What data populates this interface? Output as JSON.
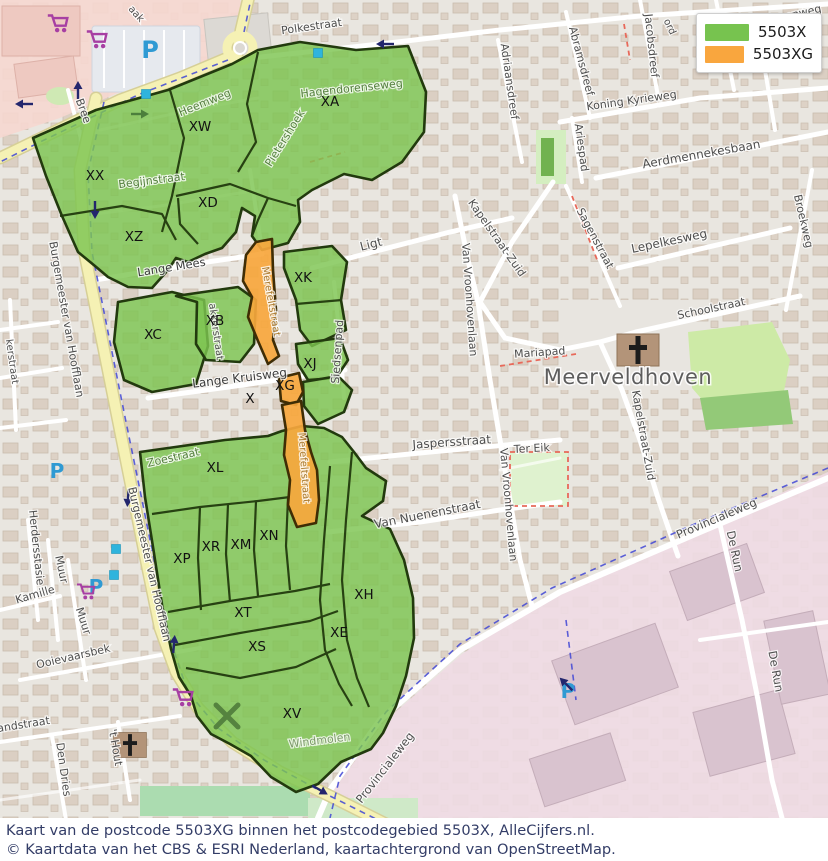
{
  "legend": {
    "items": [
      {
        "label": "5503X",
        "color": "#77c34f"
      },
      {
        "label": "5503XG",
        "color": "#f9a63e"
      }
    ]
  },
  "caption": {
    "line1": "Kaart van de postcode 5503XG binnen het postcodegebied 5503X, AlleCijfers.nl.",
    "line2": "© Kaartdata van het CBS & ESRI Nederland, kaartachtergrond van OpenStreetMap."
  },
  "map": {
    "region_fill": {
      "green": "#7cc551",
      "orange": "#f7a73d"
    },
    "place_label": {
      "text": "Meerveldhoven",
      "x": 628,
      "y": 384
    },
    "region_labels": [
      {
        "code": "XA",
        "x": 330,
        "y": 106
      },
      {
        "code": "XW",
        "x": 200,
        "y": 131
      },
      {
        "code": "XX",
        "x": 95,
        "y": 180
      },
      {
        "code": "XD",
        "x": 208,
        "y": 207
      },
      {
        "code": "XZ",
        "x": 134,
        "y": 241
      },
      {
        "code": "XK",
        "x": 303,
        "y": 282
      },
      {
        "code": "XB",
        "x": 215,
        "y": 325
      },
      {
        "code": "XC",
        "x": 153,
        "y": 339
      },
      {
        "code": "XJ",
        "x": 310,
        "y": 368
      },
      {
        "code": "X",
        "x": 250,
        "y": 403
      },
      {
        "code": "XG",
        "x": 285,
        "y": 390
      },
      {
        "code": "XL",
        "x": 215,
        "y": 472
      },
      {
        "code": "XP",
        "x": 182,
        "y": 563
      },
      {
        "code": "XR",
        "x": 211,
        "y": 551
      },
      {
        "code": "XM",
        "x": 241,
        "y": 549
      },
      {
        "code": "XN",
        "x": 269,
        "y": 540
      },
      {
        "code": "XT",
        "x": 243,
        "y": 617
      },
      {
        "code": "XS",
        "x": 257,
        "y": 651
      },
      {
        "code": "XE",
        "x": 339,
        "y": 637
      },
      {
        "code": "XH",
        "x": 364,
        "y": 599
      },
      {
        "code": "XV",
        "x": 292,
        "y": 718
      }
    ],
    "street_labels": [
      {
        "t": "Polkestraat",
        "x": 312,
        "y": 30,
        "r": -8,
        "s": 11,
        "c": "#4e4e4e"
      },
      {
        "t": "Hagendorenweg",
        "x": 778,
        "y": 22,
        "r": -13,
        "s": 11,
        "c": "#4e4e4e"
      },
      {
        "t": "ord",
        "x": 667,
        "y": 28,
        "r": 65,
        "s": 10,
        "c": "#4e4e4e"
      },
      {
        "t": "aak",
        "x": 134,
        "y": 16,
        "r": 48,
        "s": 10,
        "c": "#4e4e4e"
      },
      {
        "t": "Adriaansdreef",
        "x": 506,
        "y": 82,
        "r": 82,
        "s": 11,
        "c": "#4e4e4e"
      },
      {
        "t": "Abramsdreef",
        "x": 578,
        "y": 62,
        "r": 75,
        "s": 11,
        "c": "#4e4e4e"
      },
      {
        "t": "Jacobsdreef",
        "x": 648,
        "y": 46,
        "r": 84,
        "s": 11,
        "c": "#4e4e4e"
      },
      {
        "t": "Koning Kyrieweg",
        "x": 632,
        "y": 104,
        "r": -8,
        "s": 11,
        "c": "#4e4e4e"
      },
      {
        "t": "Ariespad",
        "x": 578,
        "y": 148,
        "r": 82,
        "s": 11,
        "c": "#4e4e4e"
      },
      {
        "t": "Aerdmennekesbaan",
        "x": 702,
        "y": 158,
        "r": -10,
        "s": 12,
        "c": "#4e4e4e"
      },
      {
        "t": "Sagenstraat",
        "x": 592,
        "y": 240,
        "r": 62,
        "s": 11,
        "c": "#4e4e4e"
      },
      {
        "t": "Lepelkesweg",
        "x": 670,
        "y": 245,
        "r": -12,
        "s": 12,
        "c": "#4e4e4e"
      },
      {
        "t": "Broekweg",
        "x": 800,
        "y": 222,
        "r": 77,
        "s": 11,
        "c": "#4e4e4e"
      },
      {
        "t": "Schoolstraat",
        "x": 712,
        "y": 312,
        "r": -12,
        "s": 11,
        "c": "#4e4e4e"
      },
      {
        "t": "Kapelstraat-Zuid",
        "x": 494,
        "y": 240,
        "r": 55,
        "s": 11,
        "c": "#4e4e4e"
      },
      {
        "t": "Kapelstraat-Zuid",
        "x": 640,
        "y": 436,
        "r": 80,
        "s": 11,
        "c": "#4e4e4e"
      },
      {
        "t": "Van Vroonhovenlaan",
        "x": 466,
        "y": 300,
        "r": 86,
        "s": 11,
        "c": "#4e4e4e"
      },
      {
        "t": "Van Vroonhovenlaan",
        "x": 505,
        "y": 505,
        "r": 85,
        "s": 11,
        "c": "#4e4e4e"
      },
      {
        "t": "Mariapad",
        "x": 540,
        "y": 356,
        "r": -4,
        "s": 11,
        "c": "#4e4e4e"
      },
      {
        "t": "Ter Eik",
        "x": 532,
        "y": 452,
        "r": -3,
        "s": 11,
        "c": "#4e4e4e"
      },
      {
        "t": "Ligt",
        "x": 372,
        "y": 248,
        "r": -14,
        "s": 12,
        "c": "#4e4e4e"
      },
      {
        "t": "Lange Mees",
        "x": 172,
        "y": 271,
        "r": -9,
        "s": 11.5,
        "c": "#3c3c3c"
      },
      {
        "t": "Begijnstraat",
        "x": 152,
        "y": 184,
        "r": -7,
        "s": 11,
        "c": "#55803f"
      },
      {
        "t": "Heemweg",
        "x": 206,
        "y": 106,
        "r": -22,
        "s": 11,
        "c": "#55803f"
      },
      {
        "t": "Hagendorenseweg",
        "x": 352,
        "y": 92,
        "r": -6,
        "s": 11,
        "c": "#55803f"
      },
      {
        "t": "Pietershoek",
        "x": 288,
        "y": 140,
        "r": -58,
        "s": 11,
        "c": "#55803f"
      },
      {
        "t": "Lange Kruisweg",
        "x": 240,
        "y": 382,
        "r": -7,
        "s": 12,
        "c": "#3c3c3c"
      },
      {
        "t": "Siedsenpad",
        "x": 341,
        "y": 352,
        "r": -86,
        "s": 11,
        "c": "#4e4e4e"
      },
      {
        "t": "Jaspersstraat",
        "x": 452,
        "y": 446,
        "r": -4,
        "s": 12,
        "c": "#4e4e4e"
      },
      {
        "t": "Van Nuenenstraat",
        "x": 428,
        "y": 518,
        "r": -11,
        "s": 12,
        "c": "#4e4e4e"
      },
      {
        "t": "Zoestraat",
        "x": 174,
        "y": 461,
        "r": -13,
        "s": 11,
        "c": "#55803f"
      },
      {
        "t": "Windmolen",
        "x": 320,
        "y": 744,
        "r": -7,
        "s": 11,
        "c": "#7d9a6b"
      },
      {
        "t": "Merefeltstraat",
        "x": 268,
        "y": 302,
        "r": 80,
        "s": 10,
        "c": "#aa7a2e"
      },
      {
        "t": "Merefeltstraat",
        "x": 301,
        "y": 468,
        "r": 86,
        "s": 10,
        "c": "#aa7a2e"
      },
      {
        "t": "akkerstraat",
        "x": 213,
        "y": 332,
        "r": 82,
        "s": 10,
        "c": "#4e4e4e"
      },
      {
        "t": "kerstraat",
        "x": 9,
        "y": 362,
        "r": 82,
        "s": 10,
        "c": "#4e4e4e"
      },
      {
        "t": "Burgemeester van Hoofflaan",
        "x": 63,
        "y": 320,
        "r": 80,
        "s": 11,
        "c": "#4e4e4e"
      },
      {
        "t": "Burgemeester van Hoofflaan",
        "x": 146,
        "y": 565,
        "r": 77,
        "s": 11,
        "c": "#4e4e4e"
      },
      {
        "t": "Muur",
        "x": 58,
        "y": 570,
        "r": 78,
        "s": 11,
        "c": "#4e4e4e"
      },
      {
        "t": "Muur",
        "x": 80,
        "y": 622,
        "r": 72,
        "s": 11,
        "c": "#4e4e4e"
      },
      {
        "t": "Herdersstasie",
        "x": 33,
        "y": 548,
        "r": 84,
        "s": 11,
        "c": "#4e4e4e"
      },
      {
        "t": "Kamille",
        "x": 36,
        "y": 598,
        "r": -16,
        "s": 11,
        "c": "#4e4e4e"
      },
      {
        "t": "Ooievaarsbek",
        "x": 74,
        "y": 660,
        "r": -13,
        "s": 11,
        "c": "#4e4e4e"
      },
      {
        "t": "andstraat",
        "x": 24,
        "y": 728,
        "r": -9,
        "s": 11,
        "c": "#4e4e4e"
      },
      {
        "t": "Den Dries",
        "x": 60,
        "y": 770,
        "r": 82,
        "s": 11,
        "c": "#4e4e4e"
      },
      {
        "t": "'t Hout",
        "x": 112,
        "y": 748,
        "r": 80,
        "s": 11,
        "c": "#4e4e4e"
      },
      {
        "t": "Bree",
        "x": 80,
        "y": 112,
        "r": 70,
        "s": 11,
        "c": "#4e4e4e"
      },
      {
        "t": "Provincialeweg",
        "x": 718,
        "y": 522,
        "r": -23,
        "s": 11.5,
        "c": "#4e4e4e"
      },
      {
        "t": "Provincialeweg",
        "x": 388,
        "y": 770,
        "r": -52,
        "s": 11.5,
        "c": "#4e4e4e"
      },
      {
        "t": "De Run",
        "x": 731,
        "y": 552,
        "r": 78,
        "s": 11.5,
        "c": "#4e4e4e"
      },
      {
        "t": "De Run",
        "x": 772,
        "y": 672,
        "r": 80,
        "s": 11.5,
        "c": "#4e4e4e"
      }
    ],
    "icons": [
      {
        "type": "parking",
        "glyph": "P",
        "x": 150,
        "y": 58,
        "s": 24
      },
      {
        "type": "parking",
        "glyph": "P",
        "x": 57,
        "y": 478,
        "s": 20
      },
      {
        "type": "parking",
        "glyph": "P",
        "x": 96,
        "y": 594,
        "s": 20
      },
      {
        "type": "parking",
        "glyph": "P",
        "x": 568,
        "y": 698,
        "s": 20
      },
      {
        "type": "cart",
        "x": 58,
        "y": 24,
        "s": 1.7
      },
      {
        "type": "cart",
        "x": 97,
        "y": 40,
        "s": 1.7
      },
      {
        "type": "cart",
        "x": 86,
        "y": 592,
        "s": 1.5
      },
      {
        "type": "cart",
        "x": 183,
        "y": 698,
        "s": 1.7
      },
      {
        "type": "church",
        "x": 638,
        "y": 350,
        "s": 1
      },
      {
        "type": "church",
        "x": 130,
        "y": 745,
        "s": 0.78
      },
      {
        "type": "square",
        "x": 146,
        "y": 94
      },
      {
        "type": "square",
        "x": 318,
        "y": 53
      },
      {
        "type": "square",
        "x": 116,
        "y": 549
      },
      {
        "type": "square",
        "x": 114,
        "y": 575
      },
      {
        "type": "windmill",
        "x": 227,
        "y": 716,
        "s": 1
      },
      {
        "type": "arrow",
        "x": 24,
        "y": 104,
        "r": 180
      },
      {
        "type": "arrow",
        "x": 78,
        "y": 90,
        "r": -90
      },
      {
        "type": "arrow",
        "x": 95,
        "y": 210,
        "r": 90
      },
      {
        "type": "arrow",
        "x": 385,
        "y": 44,
        "r": 180
      },
      {
        "type": "arrow",
        "x": 128,
        "y": 498,
        "r": 95
      },
      {
        "type": "arrow",
        "x": 174,
        "y": 644,
        "r": -85
      },
      {
        "type": "arrow",
        "x": 320,
        "y": 790,
        "r": 30
      },
      {
        "type": "arrow",
        "x": 566,
        "y": 684,
        "r": -135
      },
      {
        "type": "arrow-green",
        "x": 140,
        "y": 114,
        "r": 0
      }
    ]
  }
}
